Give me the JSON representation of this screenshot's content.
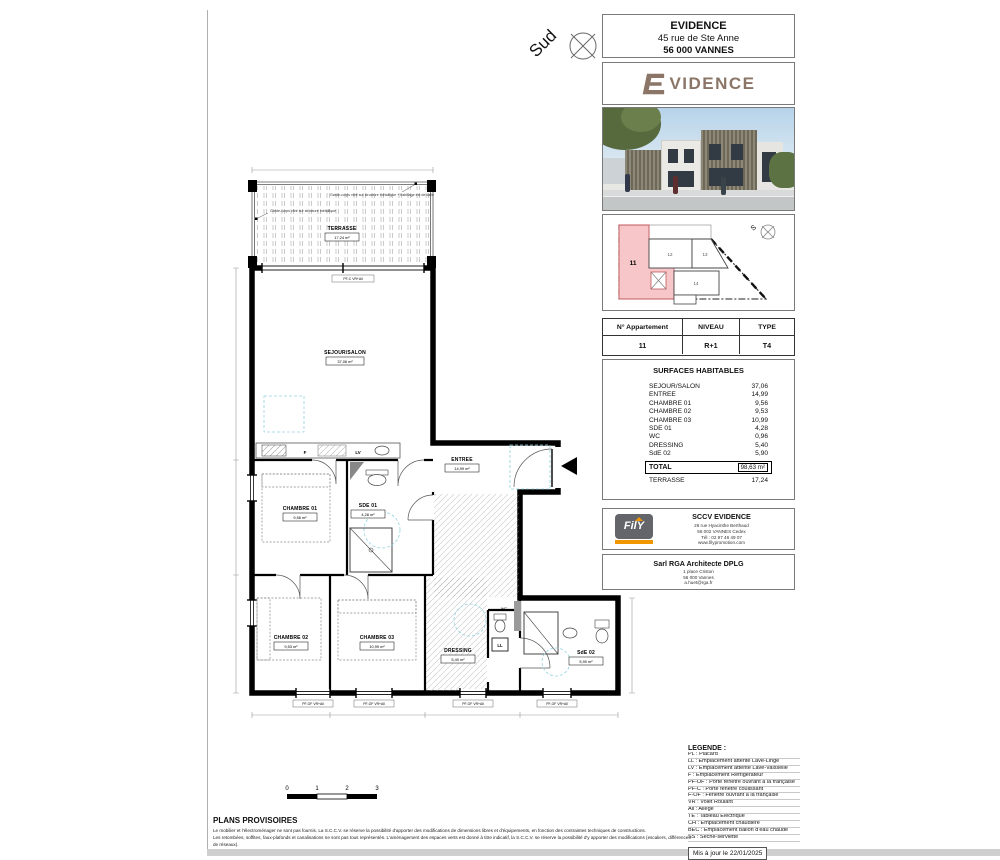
{
  "compass": {
    "label": "Sud"
  },
  "header": {
    "project_name": "EVIDENCE",
    "address1": "45 rue de Ste Anne",
    "address2": "56 000 VANNES"
  },
  "logo": {
    "wordmark": "VIDENCE"
  },
  "key_plan": {
    "compass": "S",
    "highlighted_unit": "11",
    "units": [
      "11",
      "12",
      "13",
      "14"
    ]
  },
  "apartment": {
    "headers": [
      "N° Appartement",
      "NIVEAU",
      "TYPE"
    ],
    "number": "11",
    "level": "R+1",
    "type": "T4"
  },
  "surfaces": {
    "title": "SURFACES HABITABLES",
    "rows": [
      [
        "SEJOUR/SALON",
        "37,06"
      ],
      [
        "ENTREE",
        "14,99"
      ],
      [
        "CHAMBRE 01",
        "9,56"
      ],
      [
        "CHAMBRE 02",
        "9,53"
      ],
      [
        "CHAMBRE 03",
        "10,99"
      ],
      [
        "SDE 01",
        "4,28"
      ],
      [
        "WC",
        "0,96"
      ],
      [
        "DRESSING",
        "5,40"
      ],
      [
        "SdE 02",
        "5,90"
      ]
    ],
    "total_label": "TOTAL",
    "total_value": "98,63 m²",
    "extra_label": "TERRASSE",
    "extra_value": "17,24"
  },
  "developer": {
    "logo_text": "FilY",
    "name": "SCCV EVIDENCE",
    "lines": [
      "26 rue Hyacinthe Berthaud",
      "56 002 VANNES Cedex",
      "Tél : 02 97 46 49 07",
      "www.filypromotion.com"
    ]
  },
  "architect": {
    "name": "Sarl RGA Architecte DPLG",
    "lines": [
      "1 place Criston",
      "56 000 Vannes",
      "a.huet@rga.fr"
    ]
  },
  "plan": {
    "terrasse": {
      "name": "TERRASSE",
      "area": "17,24 m²"
    },
    "sejour": {
      "name": "SEJOUR/SALON",
      "area": "37,06 m²"
    },
    "entree": {
      "name": "ENTREE",
      "area": "14,99 m²"
    },
    "chambre1": {
      "name": "CHAMBRE 01",
      "area": "9,56 m²"
    },
    "sde1": {
      "name": "SDE 01",
      "area": "4,28 m²"
    },
    "chambre2": {
      "name": "CHAMBRE 02",
      "area": "9,53 m²"
    },
    "chambre3": {
      "name": "CHAMBRE 03",
      "area": "10,99 m²"
    },
    "dressing": {
      "name": "DRESSING",
      "area": "5,40 m²"
    },
    "sde2": {
      "name": "SdE 02",
      "area": "5,90 m²"
    },
    "wc": "WC",
    "ll": "LL",
    "f": "F",
    "lv": "LV",
    "annotation_left": "Garde-corps vitré sur structure métallique",
    "annotation_right": "Garde-corps vitré sur structure métallique + habillage ext de dalle",
    "bay_label": "PF-C VR+All",
    "window_label": "PF-OF VR+All",
    "scale": {
      "ticks": [
        "0",
        "1",
        "2",
        "3"
      ]
    }
  },
  "legend": {
    "title": "LEGENDE :",
    "items": [
      "PL : Placard",
      "LL : Emplacement attente Lave-Linge",
      "LV : Emplacement attente Lave-Vaisselle",
      "F : Emplacement Réfrigérateur",
      "PF-OF : Porte fenêtre ouvrant à la française",
      "PF-C : Porte fenêtre coulissant",
      "F-OF : Fenêtre ouvrant à la française",
      "VR : Volet Roulant",
      "All : Allège",
      "TE : Tableau Electrique",
      "CH : Emplacement chaudière",
      "BEC : Emplacement ballon d'eau chaude",
      "SS : Sèche-serviette"
    ],
    "updated": "Mis à jour le 22/01/2025"
  },
  "disclaimer": {
    "title": "PLANS PROVISOIRES",
    "lines": [
      "Le mobilier et l'électroménager ne sont pas fournis. La S.C.C.V. se réserve la possibilité d'apporter des modifications de dimensions libres et d'équipements, en fonction des contraintes techniques de constructions.",
      "Les retombées, soffites, faux-plafonds et canalisations ne sont pas tous représentés. L'aménagement des espaces verts est donné à titre indicatif, la S.C.C.V. se réserve la possibilité d'y apporter des modifications (escaliers, différences de réseaux)."
    ]
  },
  "colors": {
    "highlight": "#f6c6c8",
    "brand_brown": "#8b7567",
    "fily_orange": "#f09600",
    "fily_gray": "#63656a"
  }
}
